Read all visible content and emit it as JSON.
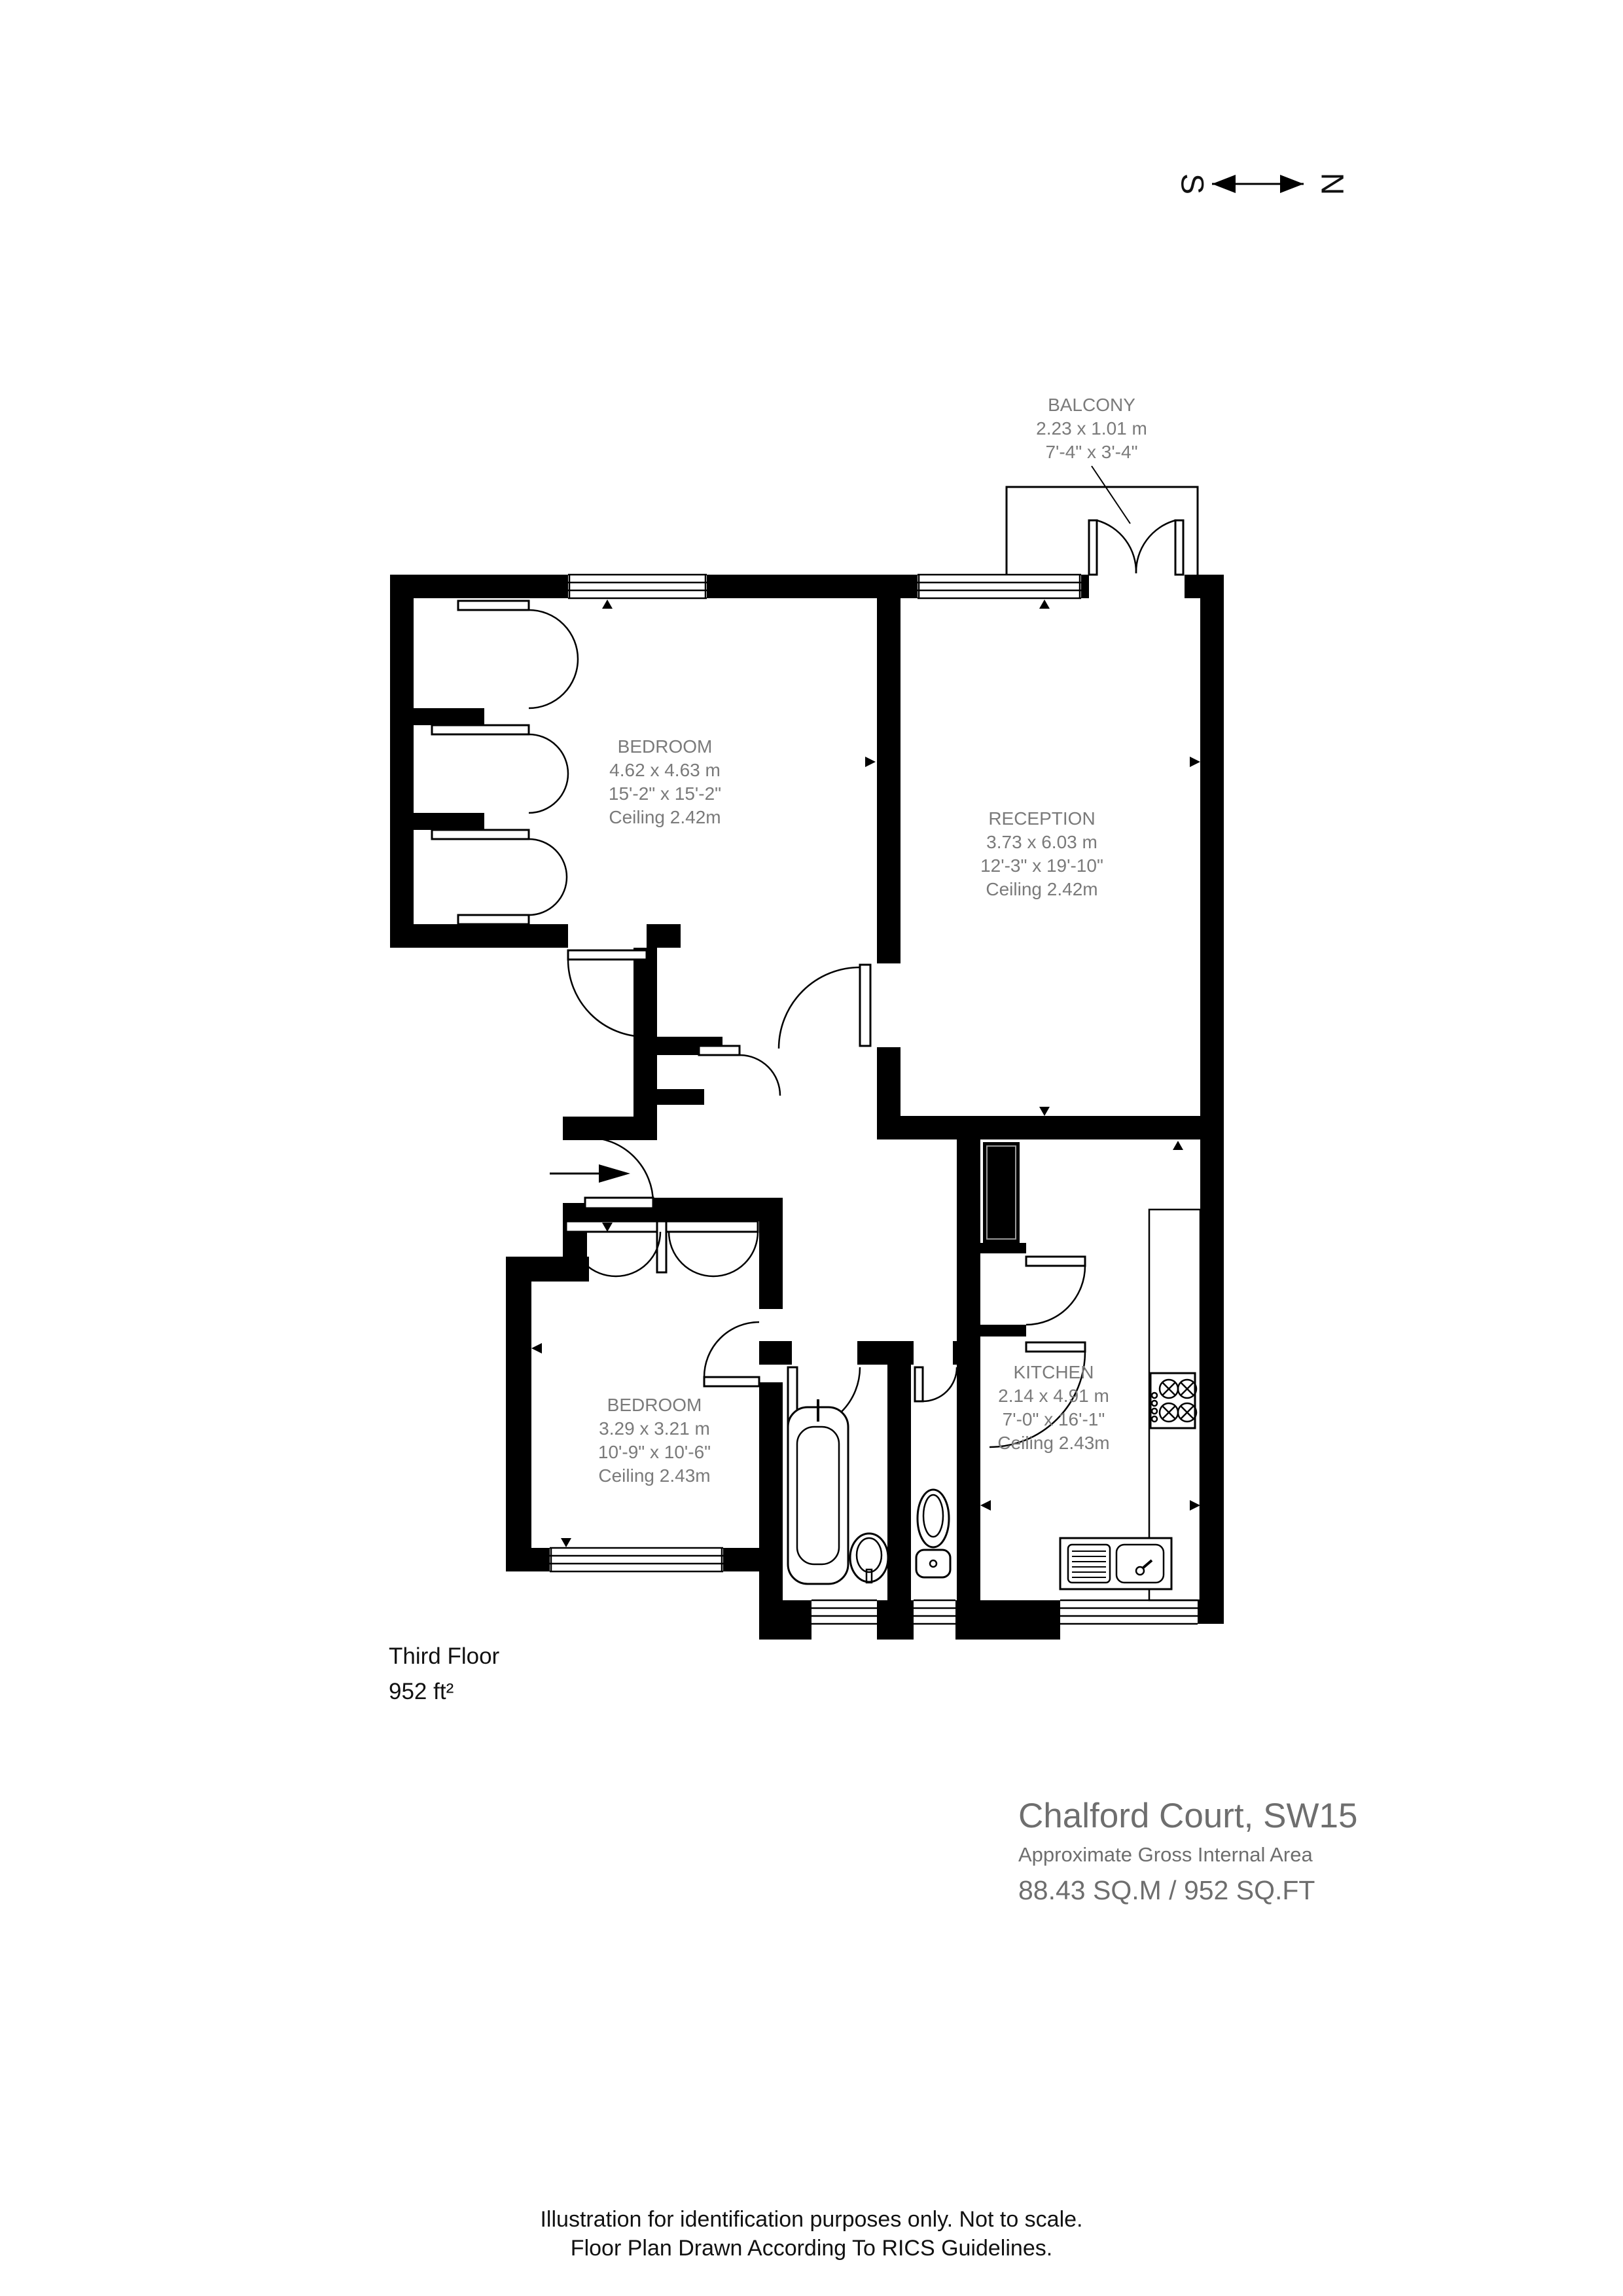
{
  "compass": {
    "south": "S",
    "north": "N"
  },
  "rooms": {
    "balcony": {
      "name": "BALCONY",
      "metric": "2.23 x 1.01 m",
      "imperial": "7'-4\" x 3'-4\""
    },
    "bedroom1": {
      "name": "BEDROOM",
      "metric": "4.62 x 4.63 m",
      "imperial": "15'-2\" x 15'-2\"",
      "ceiling": "Ceiling 2.42m"
    },
    "reception": {
      "name": "RECEPTION",
      "metric": "3.73 x 6.03 m",
      "imperial": "12'-3\" x 19'-10\"",
      "ceiling": "Ceiling 2.42m"
    },
    "kitchen": {
      "name": "KITCHEN",
      "metric": "2.14 x 4.91 m",
      "imperial": "7'-0\" x 16'-1\"",
      "ceiling": "Ceiling 2.43m"
    },
    "bedroom2": {
      "name": "BEDROOM",
      "metric": "3.29 x 3.21 m",
      "imperial": "10'-9\" x 10'-6\"",
      "ceiling": "Ceiling 2.43m"
    }
  },
  "floor_info": {
    "floor": "Third Floor",
    "area": "952 ft²"
  },
  "title_block": {
    "title": "Chalford Court, SW15",
    "subtitle": "Approximate Gross Internal Area",
    "area": "88.43 SQ.M / 952 SQ.FT"
  },
  "footer": {
    "line1": "Illustration for identification purposes only. Not to scale.",
    "line2": "Floor Plan Drawn According To RICS Guidelines."
  }
}
